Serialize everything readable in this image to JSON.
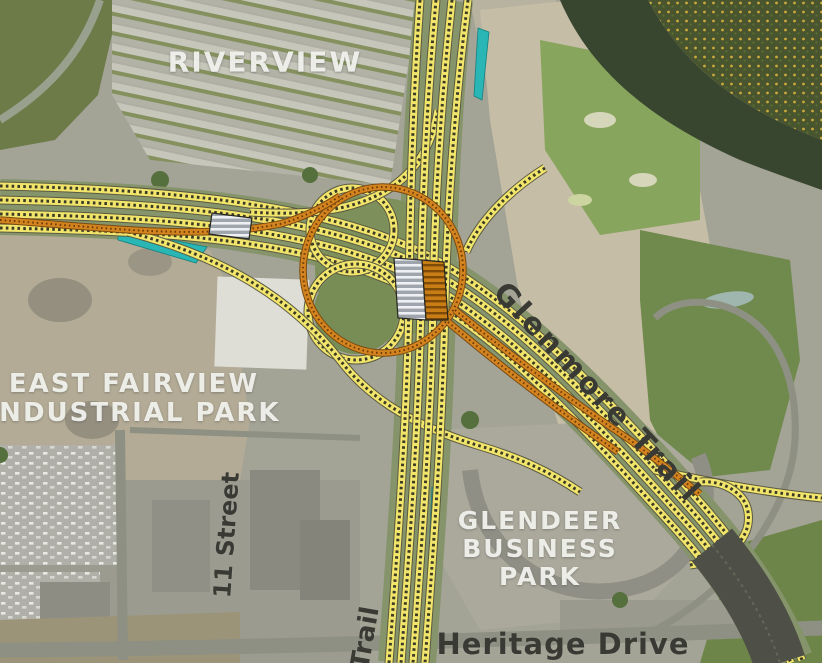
{
  "map": {
    "district_labels": {
      "riverview": "RIVERVIEW",
      "east_fairview_line1": "EAST FAIRVIEW",
      "east_fairview_line2": "INDUSTRIAL PARK",
      "glendeer_line1": "GLENDEER",
      "glendeer_line2": "BUSINESS",
      "glendeer_line3": "PARK"
    },
    "road_labels": {
      "glenmore_trail": "Glenmore Trail",
      "heritage_drive": "Heritage Drive",
      "eleven_street": "11 Street",
      "trail_partial": "Trail"
    },
    "overlay_colors": {
      "proposed_road_yellow": "#f2e56b",
      "flyover_structure_orange": "#d4841f",
      "retaining_wall_teal": "#29b6b4",
      "bridge_deck_gray": "#aab0b8",
      "bridge_deck_orange": "#c97d15",
      "river_water": "#39462f"
    }
  }
}
